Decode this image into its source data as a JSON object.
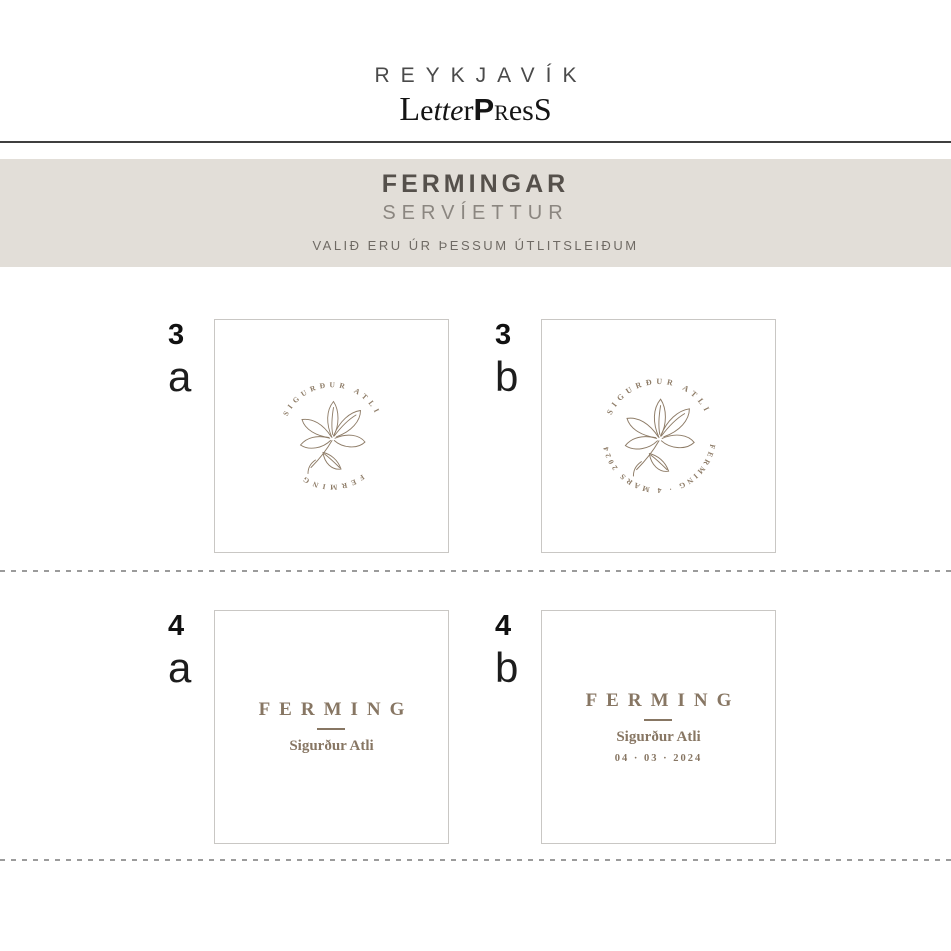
{
  "logo": {
    "city": "REYKJAVÍK",
    "press_parts": [
      "L",
      "e",
      "tte",
      "r",
      "P",
      "R",
      "es",
      "S"
    ]
  },
  "band": {
    "title": "FERMINGAR",
    "subtitle": "SERVÍETTUR",
    "note": "VALIÐ ERU ÚR ÞESSUM ÚTLITSLEIÐUM"
  },
  "colors": {
    "accent_brown": "#8d7b66",
    "band_bg": "#e2ded8",
    "rule_dark": "#3f3f3f",
    "dash_gray": "#9b9b9b"
  },
  "designs": [
    {
      "number": "3",
      "letter": "a",
      "arc_top": "SIGURÐUR ATLI",
      "arc_bottom": "FERMING"
    },
    {
      "number": "3",
      "letter": "b",
      "arc_top": "SIGURÐUR ATLI",
      "arc_bottom": "FERMING · 4 MARS 2024"
    },
    {
      "number": "4",
      "letter": "a",
      "title": "FERMING",
      "name": "Sigurður Atli"
    },
    {
      "number": "4",
      "letter": "b",
      "title": "FERMING",
      "name": "Sigurður Atli",
      "date": "04 · 03 · 2024"
    }
  ]
}
